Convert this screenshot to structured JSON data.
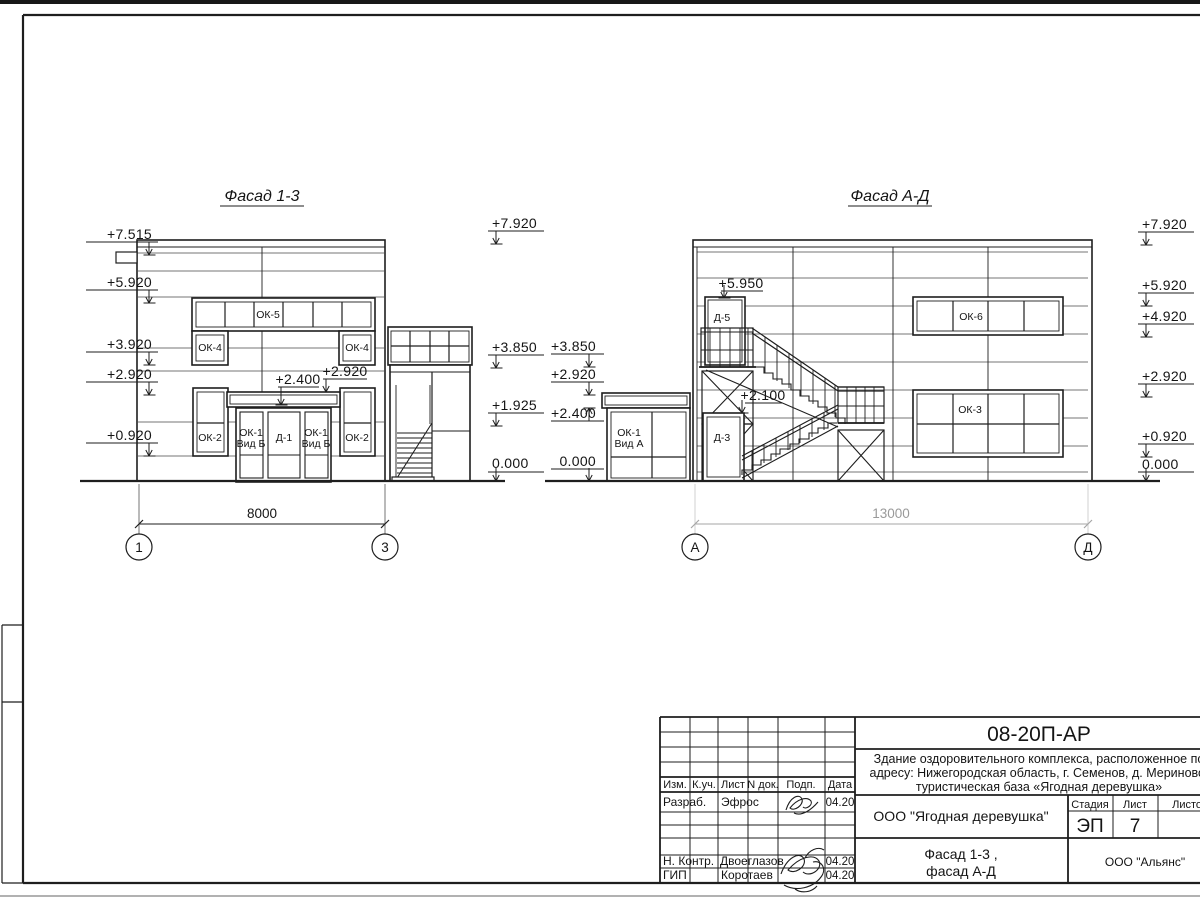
{
  "facade_1_3": {
    "title": "Фасад 1-3",
    "marks_left": [
      "+7.515",
      "+5.920",
      "+3.920",
      "+2.920",
      "+0.920"
    ],
    "marks_right": [
      "+7.920",
      "+3.850",
      "+1.925",
      "0.000"
    ],
    "canopy_marks": [
      "+2.400",
      "+2.920"
    ],
    "labels": {
      "ok5": "ОК-5",
      "ok4": "ОК-4",
      "ok2": "ОК-2",
      "ok1_line1": "ОК-1",
      "ok1_line2": "Вид Б",
      "d1": "Д-1"
    },
    "dimension": "8000",
    "axes": [
      "1",
      "3"
    ]
  },
  "facade_a_d": {
    "title": "Фасад А-Д",
    "marks_left": [
      "+3.850",
      "+2.920",
      "+2.400",
      "0.000"
    ],
    "marks_right": [
      "+7.920",
      "+5.920",
      "+4.920",
      "+2.920",
      "+0.920",
      "0.000"
    ],
    "door_marks": [
      "+5.950",
      "+2.100"
    ],
    "labels": {
      "d5": "Д-5",
      "d3": "Д-3",
      "ok6": "ОК-6",
      "ok3": "ОК-3",
      "ok1_line1": "ОК-1",
      "ok1_line2": "Вид А"
    },
    "dimension": "13000",
    "axes": [
      "А",
      "Д"
    ]
  },
  "title_block": {
    "doc_code": "08-20П-АР",
    "description_lines": [
      "Здание оздоровительного комплекса, расположенное по",
      "адресу: Нижегородская область, г. Семенов, д. Мериново,",
      "туристическая база «Ягодная деревушка»"
    ],
    "company": "ООО \"Ягодная деревушка\"",
    "subject_lines": [
      "Фасад 1-3 ,",
      "фасад А-Д"
    ],
    "contractor": "ООО \"Альянс\"",
    "stage": {
      "label": "Стадия",
      "value": "ЭП"
    },
    "sheet": {
      "label": "Лист",
      "value": "7"
    },
    "sheets_total": {
      "label": "Листов",
      "value": ""
    },
    "table_headers": [
      "Изм.",
      "К.уч.",
      "Лист",
      "N док.",
      "Подп.",
      "Дата"
    ],
    "rows": [
      {
        "role": "Разраб.",
        "name": "Эфрос",
        "date": "04.20"
      },
      {
        "role": "Н. Контр.",
        "name": "Двоеглазов",
        "date": "04.20"
      },
      {
        "role": "ГИП",
        "name": "Коротаев",
        "date": "04.20"
      }
    ]
  }
}
